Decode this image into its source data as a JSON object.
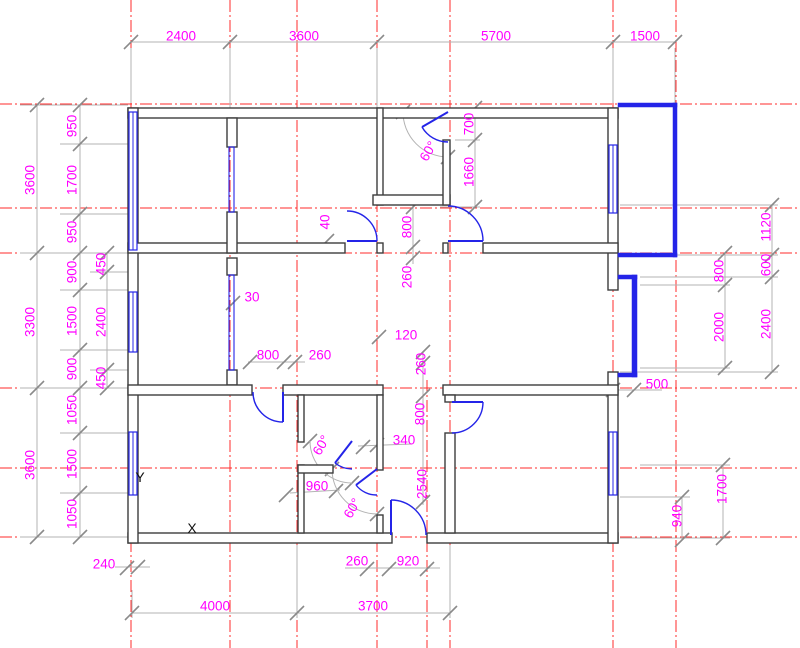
{
  "canvas": {
    "width": 800,
    "height": 648
  },
  "colors": {
    "background": "#ffffff",
    "grid_red": "#ff2b2b",
    "wall": "#3d3d3d",
    "wall_fill": "#ffffff",
    "blue": "#2424e8",
    "dim_line": "#b3b3b3",
    "tick": "#8a8a8a",
    "dim_label": "#ff00ff",
    "marker": "#111111"
  },
  "grid": {
    "vertical": [
      {
        "x": 131,
        "y0": 0,
        "y1": 648
      },
      {
        "x": 230,
        "y0": 0,
        "y1": 648
      },
      {
        "x": 297,
        "y0": 0,
        "y1": 648
      },
      {
        "x": 377,
        "y0": 0,
        "y1": 648
      },
      {
        "x": 427,
        "y0": 380,
        "y1": 648
      },
      {
        "x": 450,
        "y0": 0,
        "y1": 648
      },
      {
        "x": 613,
        "y0": 0,
        "y1": 648
      },
      {
        "x": 676,
        "y0": 0,
        "y1": 648
      }
    ],
    "horizontal": [
      {
        "y": 104,
        "x0": 0,
        "x1": 800
      },
      {
        "y": 208,
        "x0": 0,
        "x1": 800
      },
      {
        "y": 253,
        "x0": 0,
        "x1": 800
      },
      {
        "y": 388,
        "x0": 0,
        "x1": 800
      },
      {
        "y": 468,
        "x0": 0,
        "x1": 800
      },
      {
        "y": 537,
        "x0": 0,
        "x1": 800
      }
    ]
  },
  "walls": [
    [
      128,
      108,
      490,
      10
    ],
    [
      128,
      533,
      264,
      10
    ],
    [
      427,
      533,
      191,
      10
    ],
    [
      128,
      108,
      10,
      435
    ],
    [
      608,
      108,
      10,
      182
    ],
    [
      608,
      372,
      10,
      171
    ],
    [
      128,
      243,
      217,
      10
    ],
    [
      377,
      243,
      6,
      10
    ],
    [
      443,
      243,
      5,
      10
    ],
    [
      483,
      243,
      135,
      10
    ],
    [
      377,
      108,
      6,
      97
    ],
    [
      373,
      195,
      77,
      10
    ],
    [
      443,
      140,
      7,
      65
    ],
    [
      227,
      118,
      10,
      29
    ],
    [
      227,
      212,
      10,
      41
    ],
    [
      227,
      258,
      10,
      17
    ],
    [
      227,
      370,
      10,
      15
    ],
    [
      128,
      385,
      124,
      10
    ],
    [
      283,
      385,
      100,
      10
    ],
    [
      443,
      385,
      175,
      10
    ],
    [
      298,
      395,
      6,
      47
    ],
    [
      298,
      465,
      6,
      68
    ],
    [
      298,
      465,
      35,
      8
    ],
    [
      377,
      395,
      6,
      75
    ],
    [
      377,
      515,
      6,
      18
    ],
    [
      445,
      395,
      10,
      7
    ],
    [
      445,
      433,
      10,
      100
    ]
  ],
  "windows": [
    [
      129,
      112,
      8,
      138
    ],
    [
      129,
      292,
      8,
      60
    ],
    [
      129,
      432,
      8,
      63
    ],
    [
      609,
      145,
      8,
      68
    ],
    [
      609,
      432,
      8,
      63
    ]
  ],
  "glass_partitions": [
    [
      229,
      147,
      5,
      65
    ],
    [
      229,
      275,
      5,
      95
    ]
  ],
  "blue_solids": [
    [
      618,
      103,
      59,
      4
    ],
    [
      673,
      103,
      4,
      154
    ],
    [
      618,
      253,
      59,
      4
    ],
    [
      618,
      275,
      19,
      4
    ],
    [
      632,
      275,
      5,
      102
    ],
    [
      618,
      373,
      19,
      4
    ]
  ],
  "doors": [
    {
      "name": "door-room2",
      "leaf": [
        347,
        241,
        377,
        241
      ],
      "arc": "M 377 241 A 30 30 0 0 0 347 211"
    },
    {
      "name": "door-bigroom",
      "leaf": [
        448,
        241,
        483,
        241
      ],
      "arc": "M 483 241 A 35 35 0 0 0 448 206"
    },
    {
      "name": "door-storage",
      "leaf": [
        448,
        112,
        422,
        127
      ],
      "arc": "M 422 127 A 30 30 0 0 0 448 142"
    },
    {
      "name": "door-midleft",
      "leaf": [
        283,
        392,
        283,
        422
      ],
      "arc": "M 253 392 A 30 30 0 0 0 283 422"
    },
    {
      "name": "door-entry",
      "leaf": [
        391,
        500,
        391,
        535
      ],
      "arc": "M 391 500 A 35 35 0 0 1 426 535"
    },
    {
      "name": "door-bottomright",
      "leaf": [
        452,
        402,
        483,
        402
      ],
      "arc": "M 483 402 A 31 31 0 0 1 452 433"
    },
    {
      "name": "door-bath-top",
      "leaf": [
        352,
        441,
        335,
        463
      ],
      "arc": "M 335 463 A 28 28 0 0 0 352 469"
    },
    {
      "name": "door-bath-bottom",
      "leaf": [
        377,
        469,
        356,
        485
      ],
      "arc": "M 356 485 A 26 26 0 0 0 377 495"
    }
  ],
  "annotation_arcs": [
    "M 403 112 A 45 45 0 0 0 448 157",
    "M 310 441 A 42 42 0 0 0 352 483",
    "M 332 469 A 45 45 0 0 0 377 514"
  ],
  "dim_lines": [
    [
      131,
      42,
      675,
      42
    ],
    [
      37,
      105,
      37,
      537
    ],
    [
      80,
      105,
      80,
      537
    ],
    [
      107,
      253,
      107,
      388
    ],
    [
      772,
      205,
      772,
      372
    ],
    [
      725,
      253,
      725,
      368
    ],
    [
      723,
      465,
      723,
      538
    ],
    [
      682,
      497,
      682,
      540
    ],
    [
      613,
      390,
      662,
      390
    ],
    [
      475,
      108,
      475,
      207
    ],
    [
      413,
      205,
      413,
      264
    ],
    [
      423,
      352,
      423,
      505
    ],
    [
      248,
      362,
      305,
      362
    ],
    [
      345,
      568,
      440,
      568
    ],
    [
      115,
      567,
      150,
      567
    ],
    [
      290,
      493,
      340,
      490
    ],
    [
      358,
      446,
      412,
      444
    ],
    [
      132,
      613,
      450,
      613
    ],
    [
      131,
      48,
      131,
      103
    ],
    [
      230,
      48,
      230,
      108
    ],
    [
      377,
      48,
      377,
      108
    ],
    [
      613,
      48,
      613,
      103
    ],
    [
      675,
      48,
      675,
      103
    ],
    [
      20,
      105,
      128,
      105
    ],
    [
      20,
      253,
      128,
      253
    ],
    [
      20,
      388,
      128,
      388
    ],
    [
      20,
      537,
      128,
      537
    ],
    [
      60,
      144,
      128,
      144
    ],
    [
      60,
      214,
      128,
      214
    ],
    [
      60,
      290,
      128,
      290
    ],
    [
      60,
      350,
      128,
      350
    ],
    [
      60,
      433,
      128,
      433
    ],
    [
      60,
      493,
      128,
      493
    ],
    [
      90,
      272,
      128,
      272
    ],
    [
      90,
      370,
      128,
      370
    ],
    [
      620,
      205,
      778,
      205
    ],
    [
      620,
      255,
      778,
      255
    ],
    [
      640,
      277,
      778,
      277
    ],
    [
      620,
      372,
      778,
      372
    ],
    [
      640,
      285,
      730,
      285
    ],
    [
      640,
      368,
      730,
      368
    ],
    [
      640,
      465,
      730,
      465
    ],
    [
      620,
      538,
      730,
      538
    ],
    [
      620,
      497,
      690,
      497
    ],
    [
      455,
      140,
      480,
      140
    ],
    [
      440,
      207,
      480,
      207
    ],
    [
      132,
      590,
      132,
      618
    ],
    [
      297,
      545,
      297,
      618
    ],
    [
      450,
      545,
      450,
      618
    ]
  ],
  "ticks": [
    [
      131,
      42
    ],
    [
      230,
      42
    ],
    [
      377,
      42
    ],
    [
      613,
      42
    ],
    [
      675,
      42
    ],
    [
      37,
      105
    ],
    [
      37,
      253
    ],
    [
      37,
      388
    ],
    [
      37,
      537
    ],
    [
      80,
      105
    ],
    [
      80,
      144
    ],
    [
      80,
      214
    ],
    [
      80,
      253
    ],
    [
      80,
      290
    ],
    [
      80,
      350
    ],
    [
      80,
      388
    ],
    [
      80,
      433
    ],
    [
      80,
      493
    ],
    [
      80,
      537
    ],
    [
      107,
      253
    ],
    [
      107,
      272
    ],
    [
      107,
      370
    ],
    [
      107,
      388
    ],
    [
      772,
      205
    ],
    [
      772,
      255
    ],
    [
      772,
      277
    ],
    [
      772,
      372
    ],
    [
      725,
      253
    ],
    [
      725,
      285
    ],
    [
      725,
      368
    ],
    [
      723,
      465
    ],
    [
      723,
      538
    ],
    [
      682,
      497
    ],
    [
      682,
      540
    ],
    [
      613,
      390
    ],
    [
      634,
      390
    ],
    [
      475,
      108
    ],
    [
      475,
      140
    ],
    [
      475,
      207
    ],
    [
      413,
      207
    ],
    [
      413,
      247
    ],
    [
      413,
      258
    ],
    [
      423,
      352
    ],
    [
      423,
      363
    ],
    [
      423,
      396
    ],
    [
      423,
      502
    ],
    [
      250,
      362
    ],
    [
      284,
      362
    ],
    [
      295,
      362
    ],
    [
      379,
      337
    ],
    [
      327,
      241
    ],
    [
      233,
      303
    ],
    [
      336,
      491
    ],
    [
      286,
      495
    ],
    [
      363,
      447
    ],
    [
      377,
      445
    ],
    [
      367,
      569
    ],
    [
      389,
      569
    ],
    [
      427,
      569
    ],
    [
      127,
      568
    ],
    [
      138,
      567
    ],
    [
      132,
      613
    ],
    [
      297,
      613
    ],
    [
      450,
      613
    ],
    [
      403,
      112
    ],
    [
      448,
      157
    ],
    [
      310,
      441
    ],
    [
      352,
      483
    ],
    [
      332,
      469
    ],
    [
      377,
      514
    ]
  ],
  "labels": [
    {
      "t": "2400",
      "x": 181,
      "y": 36
    },
    {
      "t": "3600",
      "x": 304,
      "y": 36
    },
    {
      "t": "5700",
      "x": 496,
      "y": 36
    },
    {
      "t": "1500",
      "x": 645,
      "y": 36
    },
    {
      "t": "3600",
      "x": 30,
      "y": 180,
      "r": -90
    },
    {
      "t": "3300",
      "x": 30,
      "y": 322,
      "r": -90
    },
    {
      "t": "3600",
      "x": 30,
      "y": 465,
      "r": -90
    },
    {
      "t": "950",
      "x": 72,
      "y": 126,
      "r": -90
    },
    {
      "t": "1700",
      "x": 72,
      "y": 180,
      "r": -90
    },
    {
      "t": "950",
      "x": 72,
      "y": 232,
      "r": -90
    },
    {
      "t": "900",
      "x": 72,
      "y": 272,
      "r": -90
    },
    {
      "t": "1500",
      "x": 72,
      "y": 321,
      "r": -90
    },
    {
      "t": "900",
      "x": 72,
      "y": 369,
      "r": -90
    },
    {
      "t": "1050",
      "x": 72,
      "y": 410,
      "r": -90
    },
    {
      "t": "1500",
      "x": 72,
      "y": 464,
      "r": -90
    },
    {
      "t": "1050",
      "x": 72,
      "y": 514,
      "r": -90
    },
    {
      "t": "450",
      "x": 101,
      "y": 264,
      "r": -90
    },
    {
      "t": "2400",
      "x": 101,
      "y": 322,
      "r": -90
    },
    {
      "t": "450",
      "x": 101,
      "y": 378,
      "r": -90
    },
    {
      "t": "1120",
      "x": 766,
      "y": 227,
      "r": -90
    },
    {
      "t": "600",
      "x": 766,
      "y": 265,
      "r": -90
    },
    {
      "t": "2400",
      "x": 766,
      "y": 324,
      "r": -90
    },
    {
      "t": "800",
      "x": 719,
      "y": 271,
      "r": -90
    },
    {
      "t": "2000",
      "x": 719,
      "y": 327,
      "r": -90
    },
    {
      "t": "1700",
      "x": 722,
      "y": 489,
      "r": -90
    },
    {
      "t": "940",
      "x": 677,
      "y": 516,
      "r": -90
    },
    {
      "t": "500",
      "x": 657,
      "y": 384
    },
    {
      "t": "700",
      "x": 469,
      "y": 124,
      "r": -90
    },
    {
      "t": "1660",
      "x": 469,
      "y": 172,
      "r": -90
    },
    {
      "t": "800",
      "x": 407,
      "y": 227,
      "r": -90
    },
    {
      "t": "260",
      "x": 407,
      "y": 277,
      "r": -90
    },
    {
      "t": "40",
      "x": 325,
      "y": 222,
      "r": -90
    },
    {
      "t": "30",
      "x": 252,
      "y": 297
    },
    {
      "t": "800",
      "x": 268,
      "y": 355
    },
    {
      "t": "260",
      "x": 320,
      "y": 355
    },
    {
      "t": "120",
      "x": 406,
      "y": 335
    },
    {
      "t": "260",
      "x": 421,
      "y": 364,
      "r": -90
    },
    {
      "t": "800",
      "x": 420,
      "y": 414,
      "r": -90
    },
    {
      "t": "340",
      "x": 404,
      "y": 440
    },
    {
      "t": "960",
      "x": 317,
      "y": 486
    },
    {
      "t": "2540",
      "x": 422,
      "y": 484,
      "r": -90
    },
    {
      "t": "60°",
      "x": 428,
      "y": 151,
      "r": -60
    },
    {
      "t": "60°",
      "x": 321,
      "y": 445,
      "r": -60
    },
    {
      "t": "60°",
      "x": 352,
      "y": 508,
      "r": -60
    },
    {
      "t": "240",
      "x": 104,
      "y": 564
    },
    {
      "t": "260",
      "x": 357,
      "y": 561
    },
    {
      "t": "920",
      "x": 408,
      "y": 561
    },
    {
      "t": "4000",
      "x": 215,
      "y": 606
    },
    {
      "t": "3700",
      "x": 373,
      "y": 606
    }
  ],
  "axis_markers": [
    {
      "t": "Y",
      "x": 140,
      "y": 482
    },
    {
      "t": "X",
      "x": 192,
      "y": 533
    }
  ]
}
